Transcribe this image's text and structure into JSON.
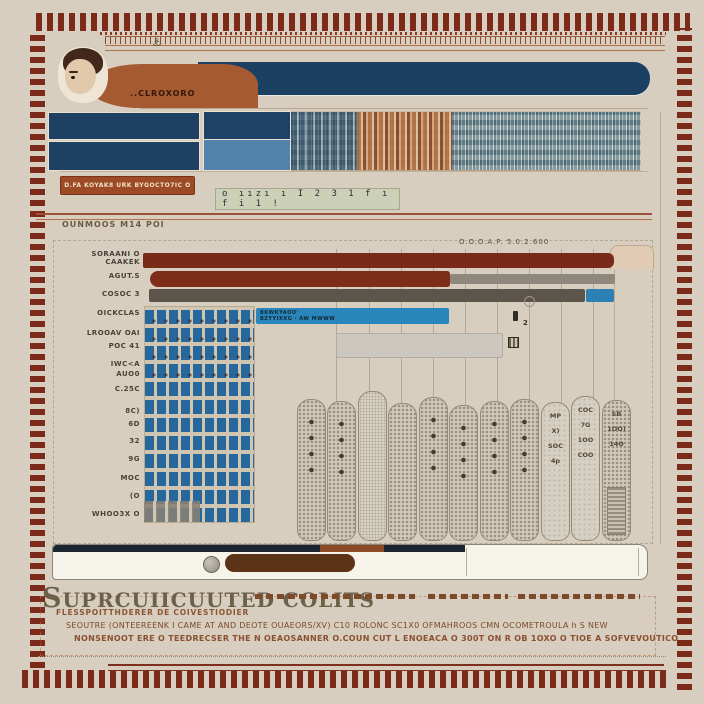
{
  "colors": {
    "background": "#d8cec0",
    "stitch_border": "#7c2b1a",
    "navy": "#1c4061",
    "steel_blue": "#5183ab",
    "bright_blue": "#2a85ba",
    "maroon_bar": "#7a2a19",
    "brown_button": "#9d4b27",
    "rust_blob": "#a55a31",
    "gray_bar": "#5c554c",
    "footer_pill": "#5c3317",
    "strip_green": "#cbd0b6"
  },
  "header": {
    "logo_label": "..CLROXORO",
    "anchor_glyph": "⚓"
  },
  "toolbar": {
    "button_label": "D.FA KOYAK8 URK BYGOCTO7IC O",
    "strip_glyphs": "o ıızı ı I 2 3 1 f  ı f i 1 !"
  },
  "section": {
    "caption": "OUNMOOS M14 POI"
  },
  "panel": {
    "note": "O.O.O.A.P. 5.0.2.600",
    "row_labels": [
      "SORAANI O CAAKEK",
      "AGUT.S",
      "COSOC 3",
      "OICKCLAS",
      "LROOAV OAI",
      "POC 41",
      "IWC<A",
      "AUO0",
      "C.25C",
      "8C)",
      "6D",
      "32",
      "9G",
      "MOC",
      "(O",
      "WHOO3X O"
    ],
    "blue_bar_text1": "BKWKYAOO'",
    "blue_bar_text2": "BZYYIXXG · AW MWWW",
    "marker2_glyph": "2",
    "capsules": [
      {
        "values": []
      },
      {
        "values": []
      },
      {
        "values": []
      },
      {
        "values": []
      },
      {
        "values": []
      },
      {
        "values": []
      },
      {
        "values": []
      },
      {
        "values": []
      },
      {
        "values": [
          "MP",
          "X)",
          "SOC",
          "4p"
        ]
      },
      {
        "values": [
          "COC",
          "7G",
          "1OO",
          "COO"
        ]
      },
      {
        "values": [
          "SB",
          "1OO)",
          "14O"
        ]
      }
    ]
  },
  "footer": {
    "heading": "Suprcuiicuuted Colits",
    "subheading": "Flesspoitthderer de Coivestiodier",
    "line1": "SEOUTRE   (ONTEEREENK I CAME AT AND DEOTE OUAEORS/XV) C10 ROLONC   SC1X0 OFMAHROOS CMN OCOMETROULA h S NEW",
    "line2": "NONSENOOT ERE O TEEDRECSER THE N OEAOSANNER O.COUN CUT L ENOEACA O 300T ON R OB 1OXO O TIOE A SOFVEVOUTICO"
  }
}
